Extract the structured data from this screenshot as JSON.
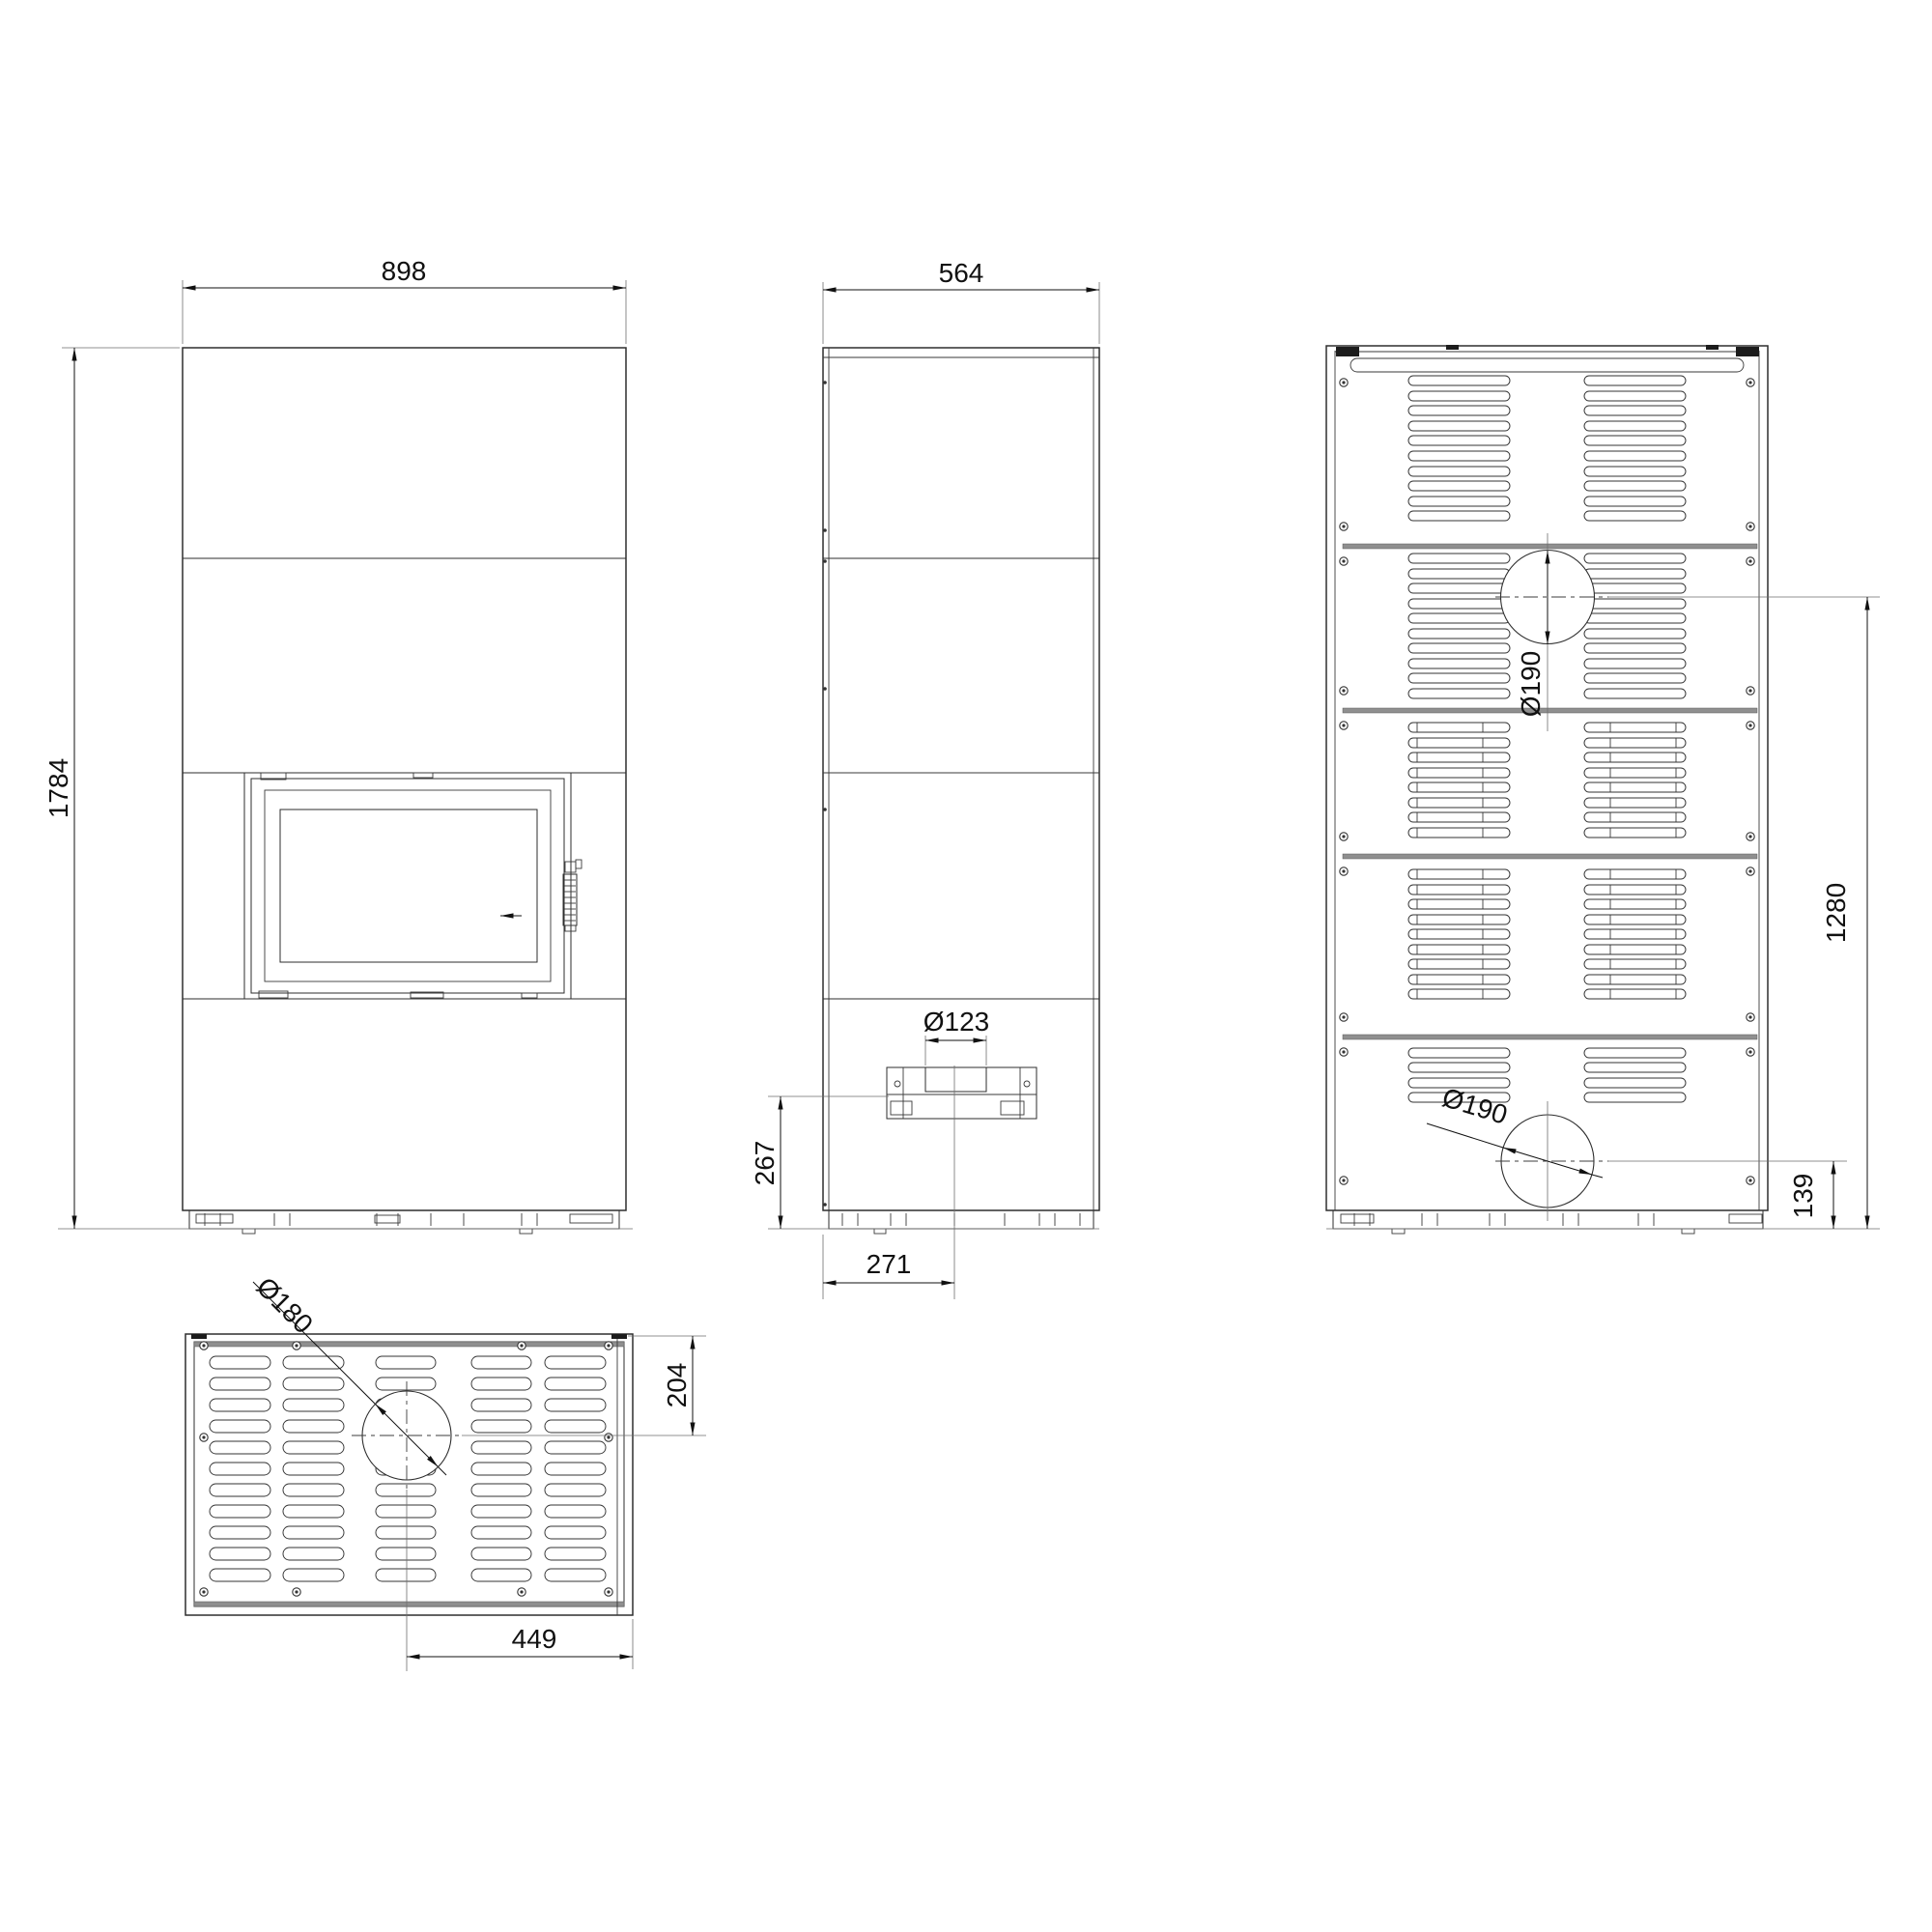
{
  "drawing": {
    "type": "fireplace-stove-dimension-drawing",
    "views": {
      "front": {
        "dims": {
          "width": "898",
          "height": "1784"
        }
      },
      "side": {
        "dims": {
          "depth": "564",
          "inlet_diameter": "Ø123",
          "inlet_center_height": "267",
          "inlet_center_offset": "271"
        }
      },
      "rear": {
        "dims": {
          "top_flue_diameter": "Ø190",
          "bottom_flue_diameter": "Ø190",
          "top_flue_center_height": "1280",
          "bottom_flue_center_height": "139"
        }
      },
      "top": {
        "dims": {
          "flue_diameter": "Ø180",
          "flue_center_from_edge": "204",
          "flue_center_from_side": "449"
        }
      }
    },
    "colors": {
      "line": "#2e2e2e",
      "thick_bar": "#8f8f8f",
      "background": "#ffffff"
    }
  }
}
